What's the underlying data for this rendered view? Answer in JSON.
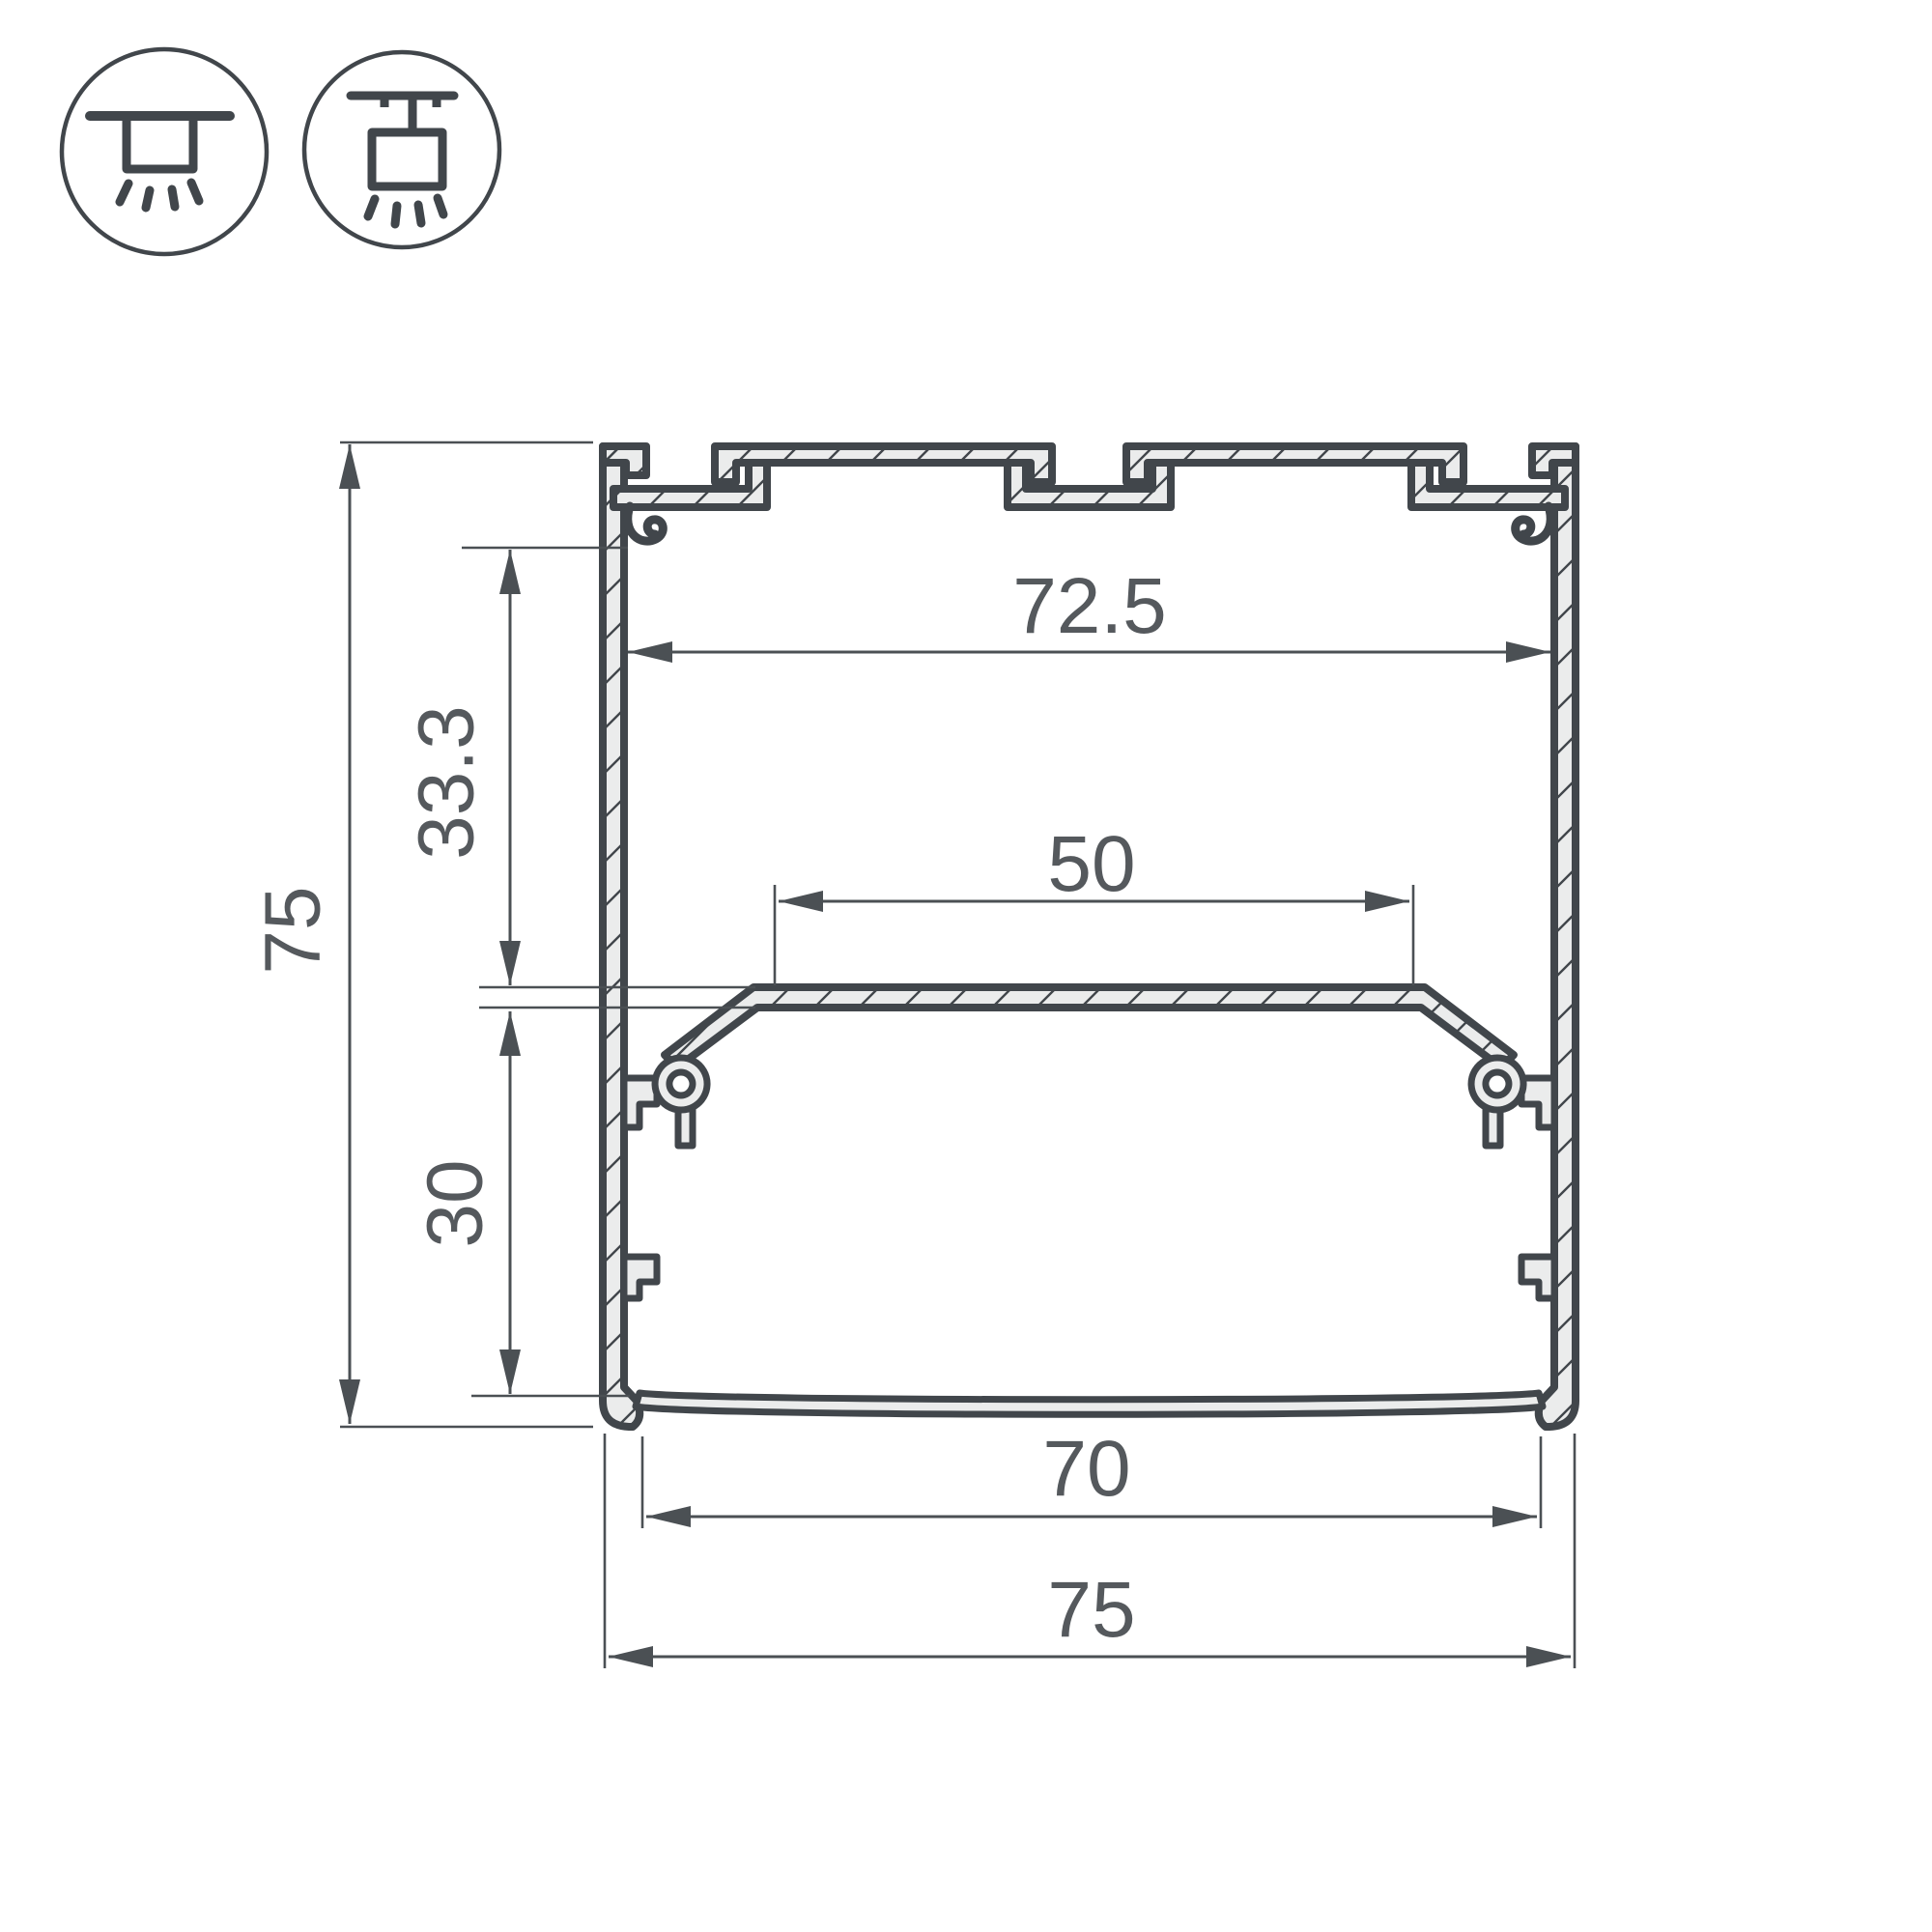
{
  "drawing": {
    "type": "aluminum-led-profile-cross-section",
    "colors": {
      "outline": "#41464b",
      "metal_fill": "#ebecec",
      "dimension_lines": "#4b5054",
      "label_text": "#55595d",
      "background": "#ffffff"
    },
    "icons": {
      "left": "surface-mount-icon",
      "right": "pendant-mount-icon"
    },
    "dimensions": {
      "overall_height": "75",
      "upper_inner_height": "33.3",
      "lower_inner_height": "30",
      "inner_width": "72.5",
      "led_plate_width": "50",
      "bottom_opening_width": "70",
      "overall_width": "75"
    }
  }
}
